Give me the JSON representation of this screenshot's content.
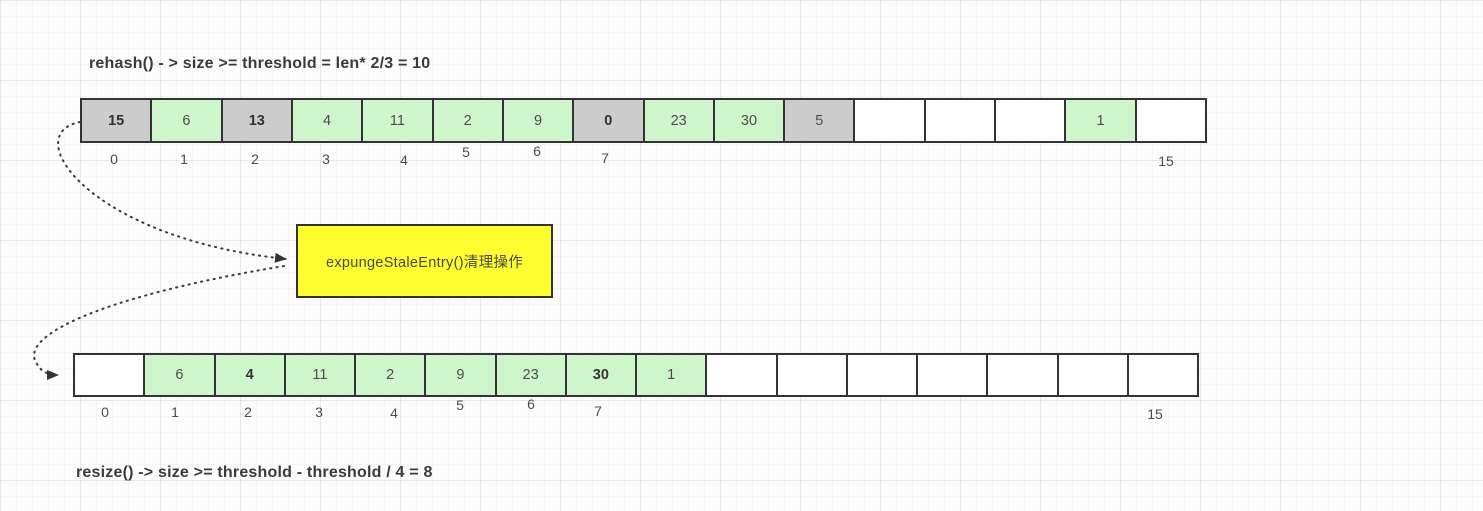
{
  "titles": {
    "top": "rehash() - > size >= threshold = len* 2/3 = 10",
    "bottom": "resize() -> size >= threshold - threshold / 4 = 8"
  },
  "note_box": {
    "label": "expungeStaleEntry()清理操作",
    "fill": "#fdfd30"
  },
  "colors": {
    "slot_empty": "#ffffff",
    "slot_live_green": "#cef5cc",
    "slot_stale_gray": "#cccccc",
    "border": "#333333",
    "note_yellow": "#fdfd30"
  },
  "arrays": {
    "top": {
      "name": "hashtable before cleanup (len = 16)",
      "cells": [
        {
          "value": "15",
          "state": "stale",
          "bold": true
        },
        {
          "value": "6",
          "state": "live",
          "bold": false
        },
        {
          "value": "13",
          "state": "stale",
          "bold": true
        },
        {
          "value": "4",
          "state": "live",
          "bold": false
        },
        {
          "value": "11",
          "state": "live",
          "bold": false
        },
        {
          "value": "2",
          "state": "live",
          "bold": false
        },
        {
          "value": "9",
          "state": "live",
          "bold": false
        },
        {
          "value": "0",
          "state": "stale",
          "bold": true
        },
        {
          "value": "23",
          "state": "live",
          "bold": false
        },
        {
          "value": "30",
          "state": "live",
          "bold": false
        },
        {
          "value": "5",
          "state": "stale",
          "bold": false
        },
        {
          "value": "",
          "state": "empty",
          "bold": false
        },
        {
          "value": "",
          "state": "empty",
          "bold": false
        },
        {
          "value": "",
          "state": "empty",
          "bold": false
        },
        {
          "value": "1",
          "state": "live",
          "bold": false
        },
        {
          "value": "",
          "state": "empty",
          "bold": false
        }
      ],
      "index_labels": [
        "0",
        "1",
        "2",
        "3",
        "4",
        "5",
        "6",
        "7",
        "15"
      ]
    },
    "bottom": {
      "name": "hashtable after cleanup (len = 16)",
      "cells": [
        {
          "value": "",
          "state": "empty",
          "bold": false
        },
        {
          "value": "6",
          "state": "live",
          "bold": false
        },
        {
          "value": "4",
          "state": "live",
          "bold": true
        },
        {
          "value": "11",
          "state": "live",
          "bold": false
        },
        {
          "value": "2",
          "state": "live",
          "bold": false
        },
        {
          "value": "9",
          "state": "live",
          "bold": false
        },
        {
          "value": "23",
          "state": "live",
          "bold": false
        },
        {
          "value": "30",
          "state": "live",
          "bold": true
        },
        {
          "value": "1",
          "state": "live",
          "bold": false
        },
        {
          "value": "",
          "state": "empty",
          "bold": false
        },
        {
          "value": "",
          "state": "empty",
          "bold": false
        },
        {
          "value": "",
          "state": "empty",
          "bold": false
        },
        {
          "value": "",
          "state": "empty",
          "bold": false
        },
        {
          "value": "",
          "state": "empty",
          "bold": false
        },
        {
          "value": "",
          "state": "empty",
          "bold": false
        },
        {
          "value": "",
          "state": "empty",
          "bold": false
        }
      ],
      "index_labels": [
        "0",
        "1",
        "2",
        "3",
        "4",
        "5",
        "6",
        "7",
        "15"
      ]
    }
  }
}
